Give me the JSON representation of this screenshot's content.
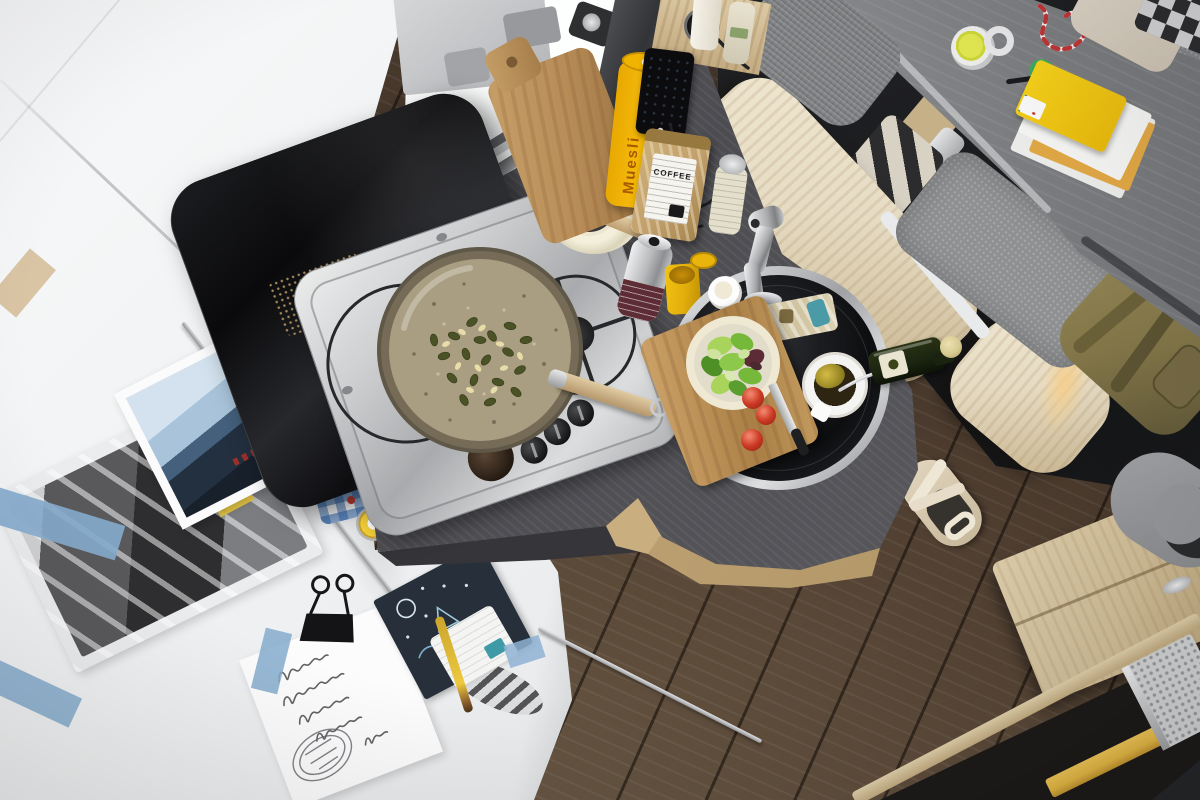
{
  "labels": {
    "coffee_bag": "COFFEE",
    "muesli_tube": "Muesli"
  },
  "palette": {
    "white_surface": "#eef0f1",
    "white_bright": "#f8f9fa",
    "floor_mid": "#5d4b3a",
    "floor_dark": "#41332a",
    "floor_light": "#71604c",
    "counter": "#4c4c51",
    "steel_light": "#eceded",
    "lid_black": "#121316",
    "wood_pale": "#e6dcc4",
    "wood_pale_dark": "#c8b48e",
    "wood_cabinet": "#d3c09a",
    "wood_board": "#b98d58",
    "table_gray": "#8e9093",
    "table_gray_dark": "#6f7174",
    "seat_gray": "#8f9092",
    "sink_black": "#0d0e10",
    "salad_green": "#76b83a",
    "salad_dark": "#4e8f26",
    "salad_light": "#a8d45c",
    "tomato_red": "#cc3a24",
    "muesli_yellow": "#f3b70a",
    "mustard_yellow": "#e2ae0c",
    "kraft_tan": "#c2a06c",
    "cream": "#efe8d2",
    "towel_blue": "#3b74b4",
    "tape_blue": "#85abcd",
    "tape_yellow": "#e9c93f",
    "glow_warm": "#f7cf8a",
    "backpack_olive": "#837749",
    "step_yellow": "#e5b844",
    "string_red": "#c03636",
    "pan_base": "#a99e82",
    "pan_rim": "#5f5747",
    "seed_green": "#4a5226",
    "nut_cream": "#e8dda8",
    "oil_bottle_green": "#1a2410",
    "oil_cap_gold": "#d6ca92"
  }
}
